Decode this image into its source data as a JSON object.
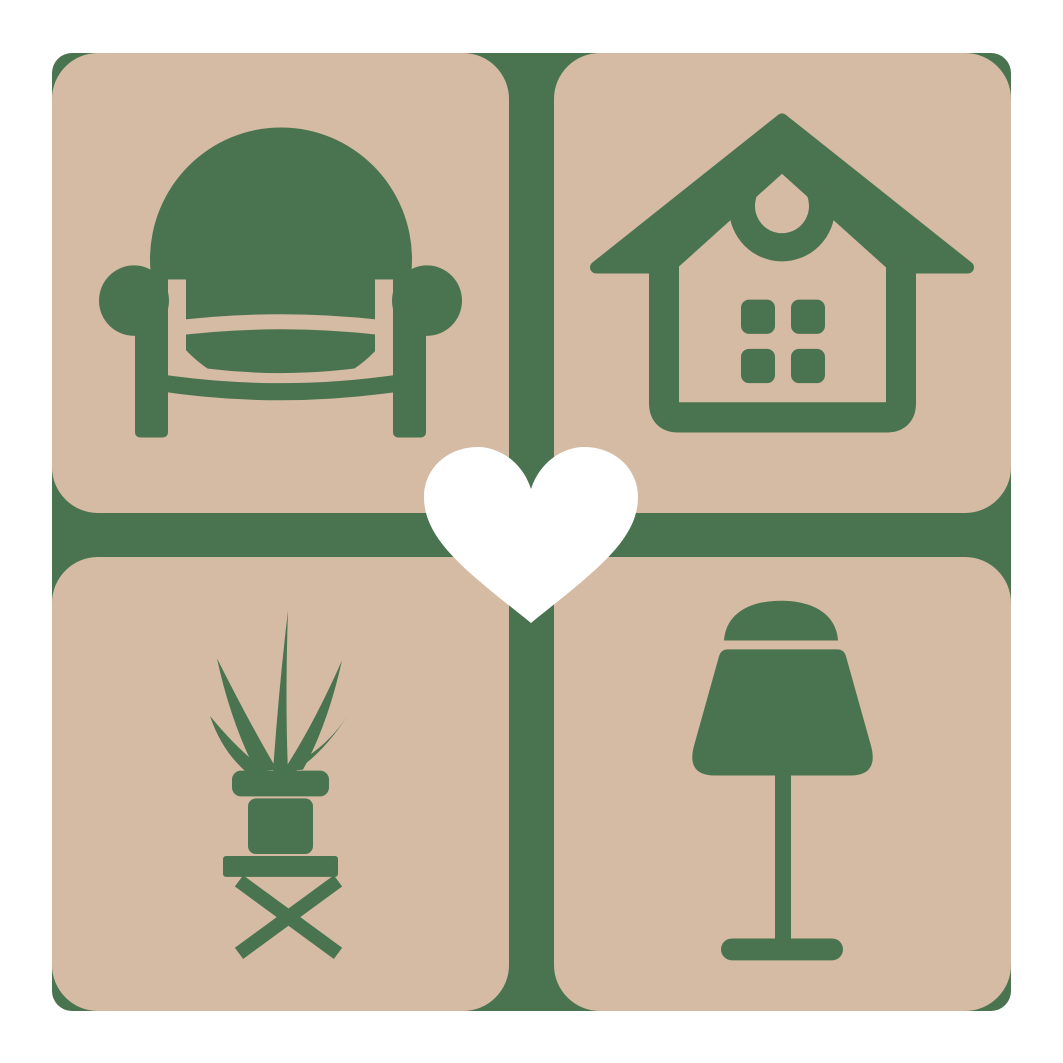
{
  "logo": {
    "colors": {
      "background": "#ffffff",
      "frame_green": "#4a7450",
      "tile_beige": "#d5bba4",
      "icon_green": "#4a7450",
      "heart_white": "#ffffff"
    },
    "grid": {
      "rows": 2,
      "cols": 2,
      "divider": "green cross gap between rounded tiles"
    },
    "tiles": [
      {
        "position": "top-left",
        "icon": "armchair-icon",
        "subject": "armchair"
      },
      {
        "position": "top-right",
        "icon": "house-icon",
        "subject": "house with crescent ornament and four windows"
      },
      {
        "position": "bottom-left",
        "icon": "potted-plant-icon",
        "subject": "spiky potted plant on cross-leg stool"
      },
      {
        "position": "bottom-right",
        "icon": "table-lamp-icon",
        "subject": "table lamp"
      }
    ],
    "center_icon": "heart-icon"
  }
}
